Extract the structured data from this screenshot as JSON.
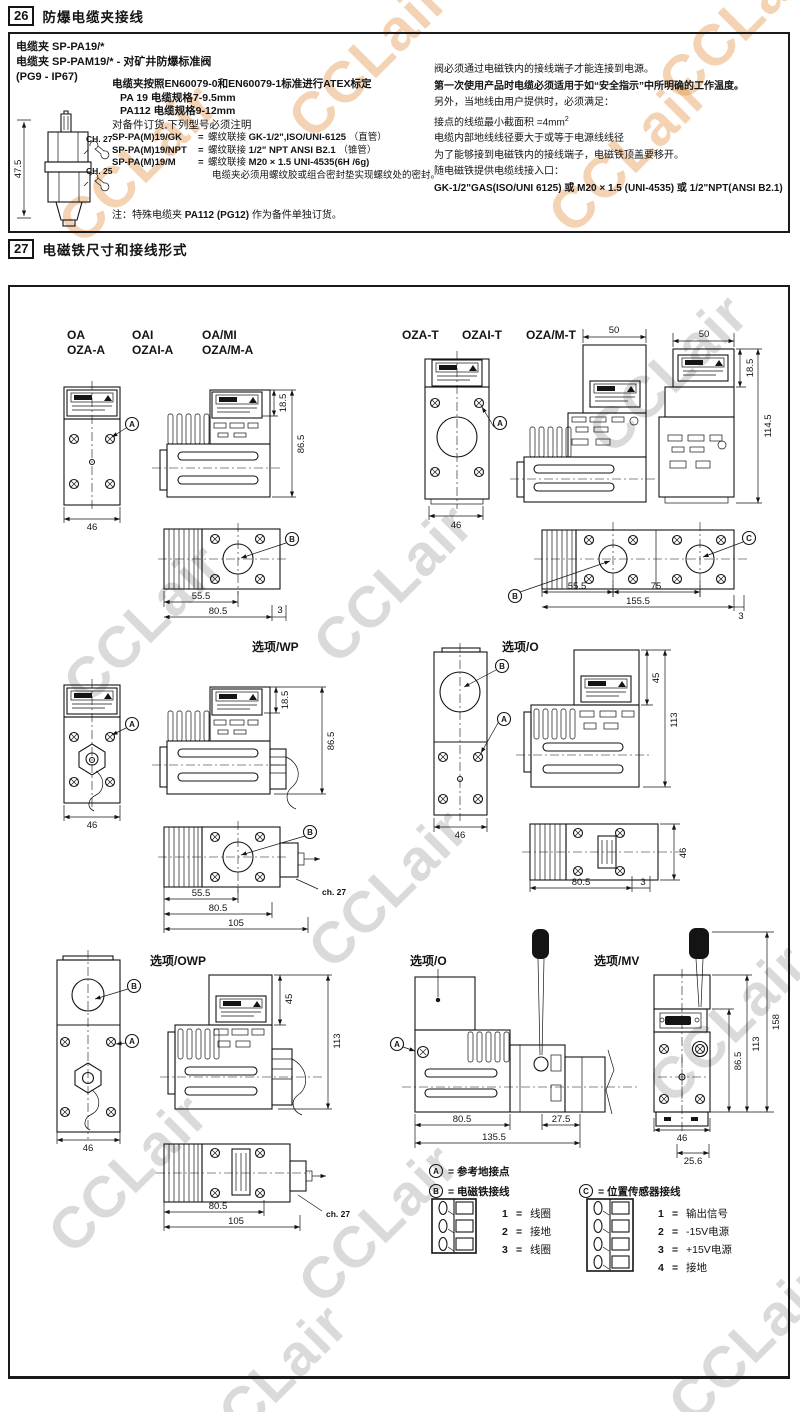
{
  "watermark": {
    "text": "CCLair"
  },
  "s26": {
    "num": "26",
    "title": "防爆电缆夹接线",
    "left": [
      "电缆夹 SP-PA19/*",
      "电缆夹 SP-PAM19/* - 对矿井防爆标准阀",
      "(PG9 - IP67)"
    ],
    "gland": {
      "height": "47.5",
      "ch27": "CH. 27",
      "ch25": "CH. 25"
    },
    "mid": {
      "intro": "电缆夹按照EN60079-0和EN60079-1标准进行ATEX标定",
      "pa19": "PA 19  电缆规格7-9.5mm",
      "pa112": "PA112 电缆规格9-12mm",
      "order": "对备件订货,下列型号必须注明",
      "models": [
        {
          "code": "SP-PA(M)19/GK",
          "mid": "螺纹联接",
          "spec": "GK-1/2\",ISO/UNI-6125",
          "suffix": "（直管）"
        },
        {
          "code": "SP-PA(M)19/NPT",
          "mid": "螺纹联接",
          "spec": "1/2\" NPT ANSI B2.1",
          "suffix": "（锥管）"
        },
        {
          "code": "SP-PA(M)19/M",
          "mid": "螺纹联接",
          "spec": "M20 × 1.5 UNI-4535(6H /6g)",
          "suffix": ""
        }
      ],
      "seal": "电缆夹必须用螺纹胶或组合密封垫实现螺纹处的密封。"
    },
    "right": {
      "l1": "阀必须通过电磁铁内的接线端子才能连接到电源。",
      "l2": "第一次使用产品时电缆必须适用于如“安全指示”中所明确的工作温度。",
      "l3": "另外，当地线由用户提供时，必须满足：",
      "l4": "接点的线缆最小截面积 =4mm",
      "l4sup": "2",
      "l5": "电缆内部地线线径要大于或等于电源线线径",
      "l6": "为了能够接到电磁铁内的接线端子，电磁铁顶盖要移开。",
      "l7": "随电磁铁提供电缆线接入口：",
      "l8": "GK-1/2\"GAS(ISO/UNI 6125) 或 M20 × 1.5 (UNI-4535) 或 1/2\"NPT(ANSI B2.1)"
    },
    "note": {
      "p1": "注：特殊电缆夹 ",
      "b": "PA112 (PG12)",
      "p2": " 作为备件单独订货。"
    },
    "eq": "="
  },
  "s27": {
    "num": "27",
    "title": "电磁铁尺寸和接线形式",
    "g1": {
      "r1": [
        "OA",
        "OAI",
        "OA/MI"
      ],
      "r2": [
        "OZA-A",
        "OZAI-A",
        "OZA/M-A"
      ]
    },
    "g2": [
      "OZA-T",
      "OZAI-T",
      "OZA/M-T"
    ],
    "opt": {
      "prefix": "选项",
      "wp": "/WP",
      "o": "/O",
      "owp": "/OWP",
      "mv": "/MV"
    },
    "marks": {
      "a": "A",
      "b": "B",
      "c": "C"
    },
    "dims": {
      "d3": "3",
      "d45": "45",
      "d46": "46",
      "d50": "50",
      "d18_5": "18.5",
      "d25_6": "25.6",
      "d27_5": "27.5",
      "d55_5": "55.5",
      "d75": "75",
      "d80_5": "80.5",
      "d86_5": "86.5",
      "d105": "105",
      "d113": "113",
      "d114_5": "114.5",
      "d135_5": "135.5",
      "d155_5": "155.5",
      "d158": "158",
      "ch27": "ch. 27"
    },
    "legend": {
      "a": "= 参考地接点",
      "b": "= 电磁铁接线",
      "c": "= 位置传感器接线",
      "b_pins": [
        {
          "n": "1",
          "t": "线圈"
        },
        {
          "n": "2",
          "t": "接地"
        },
        {
          "n": "3",
          "t": "线圈"
        }
      ],
      "c_pins": [
        {
          "n": "1",
          "t": "输出信号"
        },
        {
          "n": "2",
          "t": "-15V电源"
        },
        {
          "n": "3",
          "t": "+15V电源"
        },
        {
          "n": "4",
          "t": "接地"
        }
      ]
    }
  }
}
